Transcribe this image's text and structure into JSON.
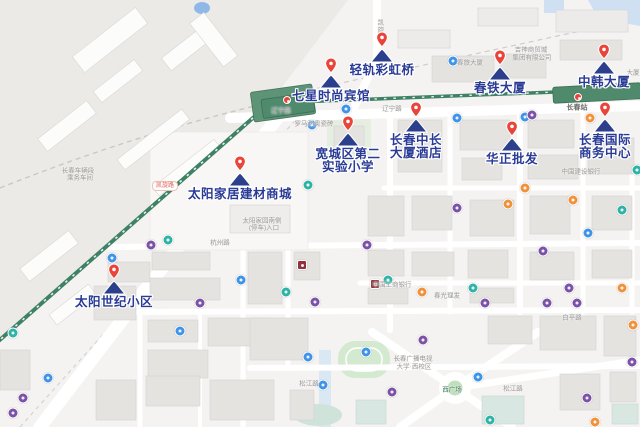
{
  "colors": {
    "poi_label": "#2a3b96",
    "pin_red": "#e8443a",
    "pin_navy": "#2b3f8c",
    "railway_green": "#3f8165",
    "station_green": "#4f8a6c",
    "road_white": "#ffffff",
    "icon_blue": "#3f93e8",
    "icon_purple": "#7a52a8",
    "icon_teal": "#2fb3a6",
    "icon_orange": "#f0913c",
    "icon_darkred": "#8f3239"
  },
  "pois": [
    {
      "id": "qinggui-caihongqiao",
      "lines": [
        "轻轨彩虹桥"
      ],
      "x": 382,
      "y": 62
    },
    {
      "id": "qixing-shishang-binguan",
      "lines": [
        "七星时尚宾馆"
      ],
      "x": 331,
      "y": 88
    },
    {
      "id": "chuntie-dasha",
      "lines": [
        "春铁大厦"
      ],
      "x": 500,
      "y": 80
    },
    {
      "id": "zhonghan-dasha",
      "lines": [
        "中韩大厦"
      ],
      "x": 604,
      "y": 74
    },
    {
      "id": "kuanchengqu-dier-shiyan-xiaoxue",
      "lines": [
        "宽城区第二",
        "实验小学"
      ],
      "x": 348,
      "y": 146
    },
    {
      "id": "changchun-zhongchang-dasha-jiudian",
      "lines": [
        "长春中长",
        "大厦酒店"
      ],
      "x": 416,
      "y": 132
    },
    {
      "id": "huazheng-pifa",
      "lines": [
        "华正批发"
      ],
      "x": 512,
      "y": 151
    },
    {
      "id": "changchun-guoji-shangwu-zhongxin",
      "lines": [
        "长春国际",
        "商务中心"
      ],
      "x": 605,
      "y": 132
    },
    {
      "id": "taiyang-jiaju-jiancai-shangcheng",
      "lines": [
        "太阳家居建材商城"
      ],
      "x": 240,
      "y": 186
    },
    {
      "id": "taiyang-shiji-xiaoqu",
      "lines": [
        "太阳世纪小区"
      ],
      "x": 114,
      "y": 294
    }
  ],
  "road_labels": [
    {
      "text": "辽宁路",
      "x": 281,
      "y": 111,
      "style": ""
    },
    {
      "text": "辽宁路",
      "x": 392,
      "y": 109,
      "style": ""
    },
    {
      "text": "长春站",
      "x": 577,
      "y": 108,
      "style": "dark"
    },
    {
      "text": "凯旋路",
      "x": 165,
      "y": 186,
      "style": "pill"
    },
    {
      "text": "凯旋路",
      "x": 379,
      "y": 30,
      "style": "vert"
    },
    {
      "text": "杭州路",
      "x": 220,
      "y": 243,
      "style": ""
    },
    {
      "text": "白平路",
      "x": 572,
      "y": 318,
      "style": ""
    },
    {
      "text": "松江路",
      "x": 309,
      "y": 384,
      "style": ""
    },
    {
      "text": "松江路",
      "x": 513,
      "y": 389,
      "style": ""
    },
    {
      "text": "西广场",
      "x": 452,
      "y": 390,
      "style": "green"
    },
    {
      "text": "春旅大厦",
      "x": 470,
      "y": 63,
      "style": ""
    },
    {
      "text": "大厦",
      "x": 633,
      "y": 73,
      "style": ""
    },
    {
      "text": "吉神商贸城",
      "x": 531,
      "y": 50,
      "style": ""
    },
    {
      "text": "集团有限公司",
      "x": 532,
      "y": 58,
      "style": ""
    },
    {
      "text": "长春车辆段",
      "x": 78,
      "y": 171,
      "style": ""
    },
    {
      "text": "乘务车间",
      "x": 80,
      "y": 178,
      "style": ""
    },
    {
      "text": "罗马利奥瓷砖",
      "x": 314,
      "y": 124,
      "style": ""
    },
    {
      "text": "太阳家园南侧",
      "x": 262,
      "y": 221,
      "style": ""
    },
    {
      "text": "(停车)入口",
      "x": 264,
      "y": 228,
      "style": ""
    },
    {
      "text": "中国工商银行",
      "x": 392,
      "y": 285,
      "style": ""
    },
    {
      "text": "中国建设银行",
      "x": 581,
      "y": 172,
      "style": ""
    },
    {
      "text": "春光理发",
      "x": 447,
      "y": 296,
      "style": ""
    },
    {
      "text": "长春广播电视",
      "x": 413,
      "y": 359,
      "style": ""
    },
    {
      "text": "大学·西校区",
      "x": 414,
      "y": 367,
      "style": ""
    }
  ],
  "transit_icons": [
    {
      "x": 453,
      "y": 61,
      "kind": "bus"
    },
    {
      "x": 346,
      "y": 109,
      "kind": "bus"
    },
    {
      "x": 312,
      "y": 125,
      "kind": "bus"
    },
    {
      "x": 457,
      "y": 118,
      "kind": "bus"
    },
    {
      "x": 525,
      "y": 117,
      "kind": "bus"
    },
    {
      "x": 588,
      "y": 233,
      "kind": "bus"
    },
    {
      "x": 241,
      "y": 280,
      "kind": "bus"
    },
    {
      "x": 180,
      "y": 331,
      "kind": "bus"
    },
    {
      "x": 308,
      "y": 357,
      "kind": "bus"
    },
    {
      "x": 323,
      "y": 385,
      "kind": "bus"
    },
    {
      "x": 366,
      "y": 352,
      "kind": "bus"
    },
    {
      "x": 478,
      "y": 377,
      "kind": "bus"
    },
    {
      "x": 48,
      "y": 378,
      "kind": "bus"
    },
    {
      "x": 112,
      "y": 258,
      "kind": "bus"
    },
    {
      "x": 367,
      "y": 245,
      "kind": "metro"
    },
    {
      "x": 457,
      "y": 208,
      "kind": "metro"
    },
    {
      "x": 543,
      "y": 251,
      "kind": "metro"
    },
    {
      "x": 569,
      "y": 288,
      "kind": "metro"
    },
    {
      "x": 151,
      "y": 245,
      "kind": "metro"
    },
    {
      "x": 200,
      "y": 303,
      "kind": "metro"
    },
    {
      "x": 315,
      "y": 302,
      "kind": "metro"
    },
    {
      "x": 423,
      "y": 340,
      "kind": "metro"
    },
    {
      "x": 392,
      "y": 392,
      "kind": "metro"
    },
    {
      "x": 23,
      "y": 398,
      "kind": "metro"
    },
    {
      "x": 13,
      "y": 413,
      "kind": "metro"
    },
    {
      "x": 485,
      "y": 303,
      "kind": "metro"
    },
    {
      "x": 547,
      "y": 303,
      "kind": "metro"
    },
    {
      "x": 577,
      "y": 303,
      "kind": "metro"
    },
    {
      "x": 632,
      "y": 362,
      "kind": "metro"
    },
    {
      "x": 587,
      "y": 398,
      "kind": "metro"
    },
    {
      "x": 532,
      "y": 115,
      "kind": "metro"
    },
    {
      "x": 308,
      "y": 185,
      "kind": "poi-teal"
    },
    {
      "x": 388,
      "y": 280,
      "kind": "poi-teal"
    },
    {
      "x": 473,
      "y": 288,
      "kind": "poi-teal"
    },
    {
      "x": 622,
      "y": 210,
      "kind": "poi-teal"
    },
    {
      "x": 286,
      "y": 292,
      "kind": "poi-teal"
    },
    {
      "x": 13,
      "y": 333,
      "kind": "poi-teal"
    },
    {
      "x": 490,
      "y": 420,
      "kind": "poi-teal"
    },
    {
      "x": 637,
      "y": 170,
      "kind": "poi-teal"
    },
    {
      "x": 168,
      "y": 240,
      "kind": "poi-teal"
    },
    {
      "x": 422,
      "y": 292,
      "kind": "poi-orange"
    },
    {
      "x": 508,
      "y": 204,
      "kind": "poi-orange"
    },
    {
      "x": 622,
      "y": 288,
      "kind": "poi-orange"
    },
    {
      "x": 633,
      "y": 325,
      "kind": "poi-orange"
    },
    {
      "x": 595,
      "y": 422,
      "kind": "poi-orange"
    },
    {
      "x": 573,
      "y": 200,
      "kind": "poi-orange"
    },
    {
      "x": 525,
      "y": 188,
      "kind": "poi-orange"
    },
    {
      "x": 590,
      "y": 118,
      "kind": "poi-orange"
    },
    {
      "x": 302,
      "y": 265,
      "kind": "bank"
    },
    {
      "x": 375,
      "y": 284,
      "kind": "bank"
    }
  ],
  "station_markers": [
    {
      "x": 287,
      "y": 100
    },
    {
      "x": 578,
      "y": 97
    }
  ]
}
